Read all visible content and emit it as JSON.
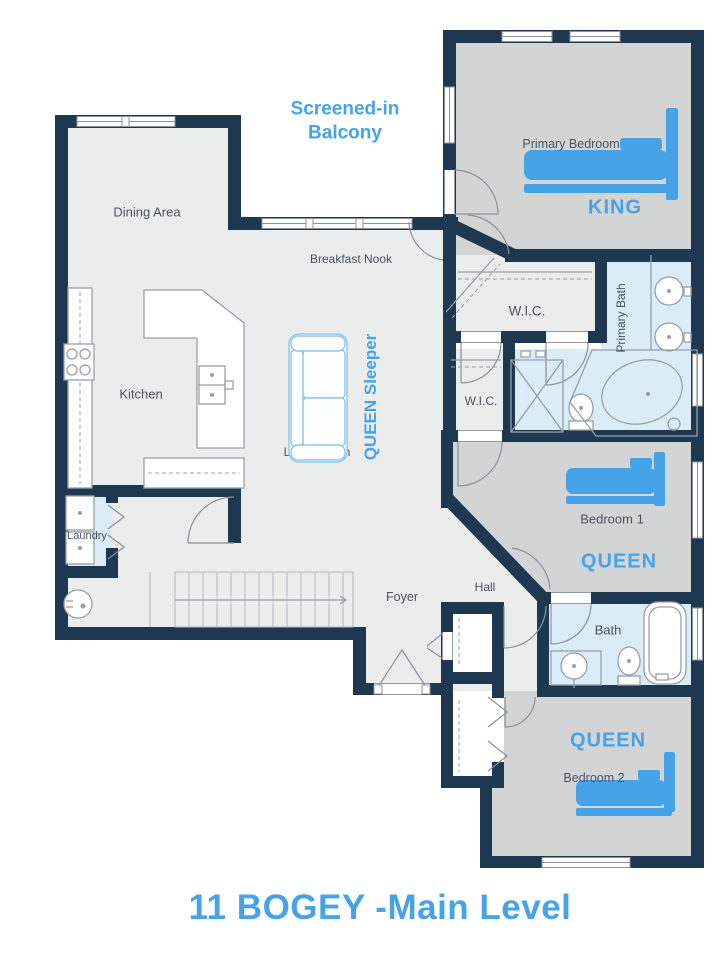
{
  "title": "11 BOGEY -Main Level",
  "theme": {
    "wall_color": "#1d3850",
    "accent_blue": "#47a3e8",
    "living_fill": "#ebecec",
    "bedroom_fill": "#d3d4d4",
    "bath_fill": "#d9ecf8",
    "label_color": "#4a5560",
    "furniture_stroke": "#98a0a7",
    "window_stroke": "#8d959c"
  },
  "rooms": {
    "balcony": "Screened-in Balcony",
    "dining": "Dining Area",
    "breakfast_nook": "Breakfast Nook",
    "kitchen": "Kitchen",
    "living": "Living Room",
    "hall": "Hall",
    "foyer": "Foyer",
    "laundry": "Laundry",
    "primary_bedroom": "Primary Bedroom",
    "primary_bath": "Primary Bath",
    "wic_1": "W.I.C.",
    "wic_2": "W.I.C.",
    "bedroom_1": "Bedroom 1",
    "bath": "Bath",
    "bedroom_2": "Bedroom 2"
  },
  "bed_tags": {
    "primary": "KING",
    "bedroom_1": "QUEEN",
    "bedroom_2": "QUEEN",
    "sleeper": "QUEEN Sleeper"
  }
}
